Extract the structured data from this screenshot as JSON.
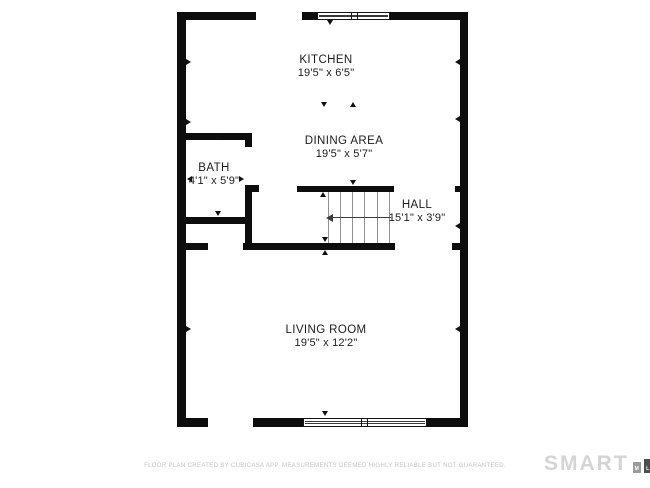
{
  "page": {
    "width": 650,
    "height": 488,
    "background": "#ffffff"
  },
  "floorplan": {
    "wall_color": "#0d0d0d",
    "stair_line_color": "#8f8f8f",
    "walls": [
      {
        "name": "outer-wall-top-left",
        "x": 177,
        "y": 12,
        "w": 79,
        "h": 8
      },
      {
        "name": "outer-wall-top-mid",
        "x": 302,
        "y": 12,
        "w": 15,
        "h": 8
      },
      {
        "name": "outer-wall-top-right",
        "x": 390,
        "y": 12,
        "w": 78,
        "h": 8
      },
      {
        "name": "outer-wall-left",
        "x": 177,
        "y": 12,
        "w": 9,
        "h": 415
      },
      {
        "name": "outer-wall-right",
        "x": 460,
        "y": 12,
        "w": 8,
        "h": 415
      },
      {
        "name": "outer-wall-bottom-left",
        "x": 177,
        "y": 418,
        "w": 31,
        "h": 9
      },
      {
        "name": "outer-wall-bottom-mid",
        "x": 253,
        "y": 418,
        "w": 50,
        "h": 9
      },
      {
        "name": "outer-wall-bottom-right",
        "x": 427,
        "y": 418,
        "w": 41,
        "h": 9
      },
      {
        "name": "bath-top-wall",
        "x": 186,
        "y": 133,
        "w": 66,
        "h": 7
      },
      {
        "name": "bath-door-jamb-top",
        "x": 245,
        "y": 133,
        "w": 7,
        "h": 14
      },
      {
        "name": "bath-right-wall",
        "x": 245,
        "y": 185,
        "w": 7,
        "h": 65
      },
      {
        "name": "bath-door-jamb-bottom",
        "x": 245,
        "y": 185,
        "w": 14,
        "h": 7
      },
      {
        "name": "bath-bottom-wall",
        "x": 186,
        "y": 217,
        "w": 66,
        "h": 7
      },
      {
        "name": "hall-bottom-wall-left",
        "x": 186,
        "y": 243,
        "w": 22,
        "h": 7
      },
      {
        "name": "hall-bottom-wall-main",
        "x": 243,
        "y": 243,
        "w": 152,
        "h": 7
      },
      {
        "name": "hall-bottom-wall-stub",
        "x": 452,
        "y": 243,
        "w": 8,
        "h": 7
      },
      {
        "name": "stairs-top-wall",
        "x": 297,
        "y": 186,
        "w": 97,
        "h": 6
      },
      {
        "name": "stairs-top-wall-stub",
        "x": 455,
        "y": 186,
        "w": 5,
        "h": 6
      }
    ],
    "windows": [
      {
        "name": "kitchen-window",
        "x": 317,
        "y": 12,
        "w": 73,
        "h": 8,
        "dividers": [
          33,
          39
        ]
      },
      {
        "name": "living-room-window",
        "x": 303,
        "y": 418,
        "w": 124,
        "h": 9,
        "dividers": [
          57,
          63
        ]
      }
    ],
    "stairs": {
      "x_lines": [
        328,
        340,
        352,
        364,
        377,
        389
      ],
      "y_top": 192,
      "y_bottom": 243,
      "arrow": {
        "y": 217,
        "x1": 333,
        "x2": 391,
        "head_x": 326
      }
    },
    "markers": [
      {
        "x": 186,
        "y": 59,
        "dir": "right"
      },
      {
        "x": 455,
        "y": 59,
        "dir": "left"
      },
      {
        "x": 327,
        "y": 20,
        "dir": "down"
      },
      {
        "x": 321,
        "y": 102,
        "dir": "down"
      },
      {
        "x": 350,
        "y": 102,
        "dir": "up"
      },
      {
        "x": 186,
        "y": 119,
        "dir": "right"
      },
      {
        "x": 215,
        "y": 134,
        "dir": "up"
      },
      {
        "x": 187,
        "y": 176,
        "dir": "left"
      },
      {
        "x": 239,
        "y": 176,
        "dir": "right"
      },
      {
        "x": 215,
        "y": 211,
        "dir": "down"
      },
      {
        "x": 350,
        "y": 180,
        "dir": "down"
      },
      {
        "x": 320,
        "y": 192,
        "dir": "up"
      },
      {
        "x": 455,
        "y": 116,
        "dir": "left"
      },
      {
        "x": 455,
        "y": 223,
        "dir": "left"
      },
      {
        "x": 322,
        "y": 237,
        "dir": "down"
      },
      {
        "x": 322,
        "y": 250,
        "dir": "up"
      },
      {
        "x": 186,
        "y": 326,
        "dir": "right"
      },
      {
        "x": 455,
        "y": 326,
        "dir": "left"
      },
      {
        "x": 322,
        "y": 411,
        "dir": "down"
      }
    ],
    "rooms": [
      {
        "id": "kitchen",
        "name": "KITCHEN",
        "dims": "19'5\" x 6'5\"",
        "cx": 326,
        "cy": 67
      },
      {
        "id": "dining-area",
        "name": "DINING AREA",
        "dims": "19'5\" x 5'7\"",
        "cx": 344,
        "cy": 148
      },
      {
        "id": "bath",
        "name": "BATH",
        "dims": "4'1\" x 5'9\"",
        "cx": 214,
        "cy": 175
      },
      {
        "id": "hall",
        "name": "HALL",
        "dims": "15'1\" x 3'9\"",
        "cx": 417,
        "cy": 212
      },
      {
        "id": "living-room",
        "name": "LIVING ROOM",
        "dims": "19'5\" x 12'2\"",
        "cx": 326,
        "cy": 337
      }
    ]
  },
  "footer": {
    "disclaimer": "FLOOR PLAN CREATED BY CUBICASA APP. MEASUREMENTS DEEMED HIGHLY RELIABLE BUT NOT GUARANTEED.",
    "logo_text": "SMART",
    "logo_bars": [
      {
        "letter": "M",
        "color": "#9b9b9b",
        "w": 8,
        "h": 11
      },
      {
        "letter": "L",
        "color": "#4f4f4f",
        "w": 8,
        "h": 14
      },
      {
        "letter": "S",
        "color": "#1f1f1f",
        "w": 10,
        "h": 18
      }
    ]
  }
}
